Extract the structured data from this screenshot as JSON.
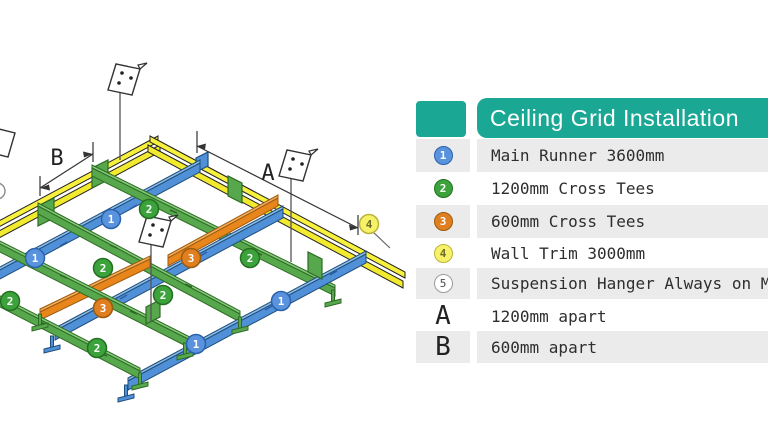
{
  "legend": {
    "accent_color": "#1aa794",
    "row_alt_color": "#ebebeb",
    "header": {
      "title": "Ceiling Grid Installation"
    },
    "rows": [
      {
        "badge": "1",
        "badge_color": "#5a93dd",
        "text": "Main Runner 3600mm"
      },
      {
        "badge": "2",
        "badge_color": "#3ca23c",
        "text": "1200mm Cross Tees"
      },
      {
        "badge": "3",
        "badge_color": "#e07f1f",
        "text": "600mm Cross Tees"
      },
      {
        "badge": "4",
        "badge_color": "#f6f167",
        "text": "Wall Trim 3000mm"
      },
      {
        "badge": "5",
        "badge_color": "#ffffff",
        "text": "Suspension Hanger Always on M"
      },
      {
        "badge": "A",
        "badge_color": "",
        "text": "1200mm apart"
      },
      {
        "badge": "B",
        "badge_color": "",
        "text": "600mm apart"
      }
    ]
  },
  "diagram": {
    "dimension_labels": {
      "a": "A",
      "b": "B"
    },
    "badge_labels": {
      "one": "1",
      "two": "2",
      "three": "3",
      "four": "4",
      "five": "5"
    },
    "colors": {
      "main_runner": "#4f90d9",
      "cross_tee_1200": "#57a84c",
      "cross_tee_600": "#e8861c",
      "wall_trim": "#f7f13e",
      "hanger_plate": "#ffffff"
    }
  }
}
